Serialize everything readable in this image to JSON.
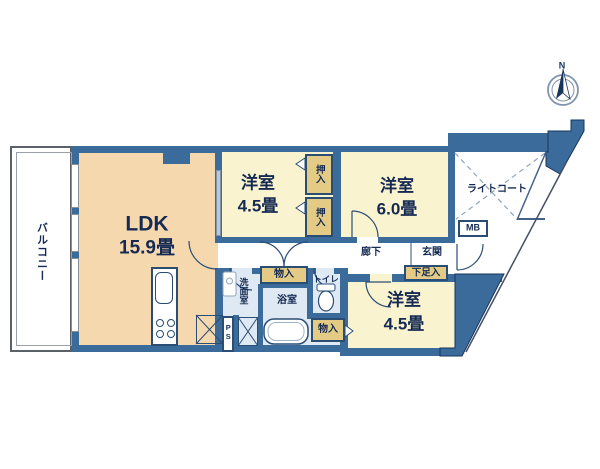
{
  "plan_title": "floor-plan",
  "colors": {
    "wall": "#3A6B9A",
    "ldk_fill": "#F6D8AF",
    "bedroom_fill": "#FAF3CF",
    "wet_area_fill": "#DEE9F4",
    "closet_fill": "#E3CB85",
    "text": "#152A52"
  },
  "rooms": {
    "balcony": {
      "label": "バルコニー"
    },
    "ldk": {
      "label": "LDK",
      "size": "15.9畳"
    },
    "bedroom_top": {
      "label": "洋室",
      "size": "4.5畳"
    },
    "bedroom_east": {
      "label": "洋室",
      "size": "6.0畳"
    },
    "bedroom_south": {
      "label": "洋室",
      "size": "4.5畳"
    },
    "light_court": {
      "label": "ライトコート"
    },
    "corridor": {
      "label": "廊下"
    },
    "entrance": {
      "label": "玄関"
    },
    "washroom": {
      "label": "洗面室"
    },
    "bathroom": {
      "label": "浴室"
    },
    "toilet": {
      "label": "トイレ"
    }
  },
  "storage": {
    "oshiire_upper": {
      "label": "押入"
    },
    "oshiire_lower": {
      "label": "押入"
    },
    "monoire_hall": {
      "label": "物入"
    },
    "monoire_south": {
      "label": "物入"
    },
    "shoe_cabinet": {
      "label": "下足入"
    },
    "meter_box": {
      "label": "MB"
    },
    "pipe_space": {
      "label": "PS"
    }
  },
  "compass": {
    "north": "N"
  }
}
